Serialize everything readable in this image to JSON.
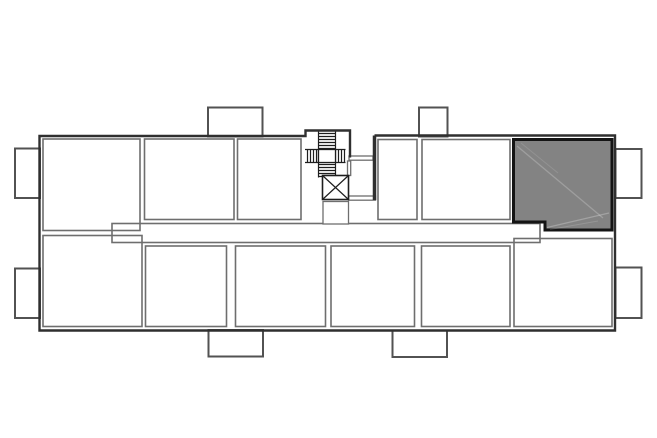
{
  "plan": {
    "description": "apartment building floor plan",
    "highlighted_unit": {
      "location": "top-right",
      "state": "highlighted"
    },
    "counts": {
      "top_row_rooms": 5,
      "bottom_row_rooms": 6,
      "balconies": 8,
      "stairwells": 1,
      "elevators": 1
    }
  },
  "colors": {
    "background": "#ffffff",
    "outer_wall": "#2f2f2f",
    "inner_wall": "#6e6e6e",
    "balcony_wall": "#525252",
    "core_detail": "#1e1e1e",
    "unit_fill": "#838383",
    "unit_border": "#141414"
  }
}
